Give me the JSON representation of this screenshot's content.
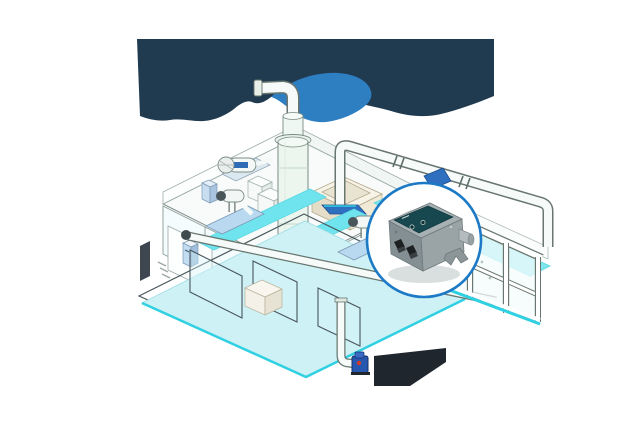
{
  "scene": {
    "name": "aquaculture-water-treatment-facility-illustration",
    "width": 640,
    "height": 425,
    "background": "#ffffff"
  },
  "palette": {
    "navy_blob": "#203a50",
    "blue_blob": "#2e7ec2",
    "floor_white": "#f8fbfa",
    "wall_white": "#fdfefe",
    "outline_gray": "#7c8c88",
    "water_surface": "#cdf1f5",
    "channel_cyan": "#6fe4ee",
    "cyan_edge": "#2fd0e2",
    "pipe_fill": "#f6faf8",
    "pipe_outline": "#68766f",
    "pump_base_blue": "#b8d9f0",
    "flange_blue": "#2f6fc0",
    "tank_body": "#ecf6ef",
    "basin_cream": "#efe9d6",
    "cabinet_glass": "#f4fbfc",
    "shadow_dark": "#0d141b",
    "callout_border": "#1b79c6",
    "callout_fill": "#ffffff",
    "device_body_top": "#a7b0b2",
    "device_body_front": "#848f93",
    "device_body_side": "#9aa4a7",
    "device_panel_teal": "#17474f",
    "device_gland_black": "#1d2022",
    "valve_blue": "#2857b0",
    "valve_red": "#d0392b",
    "wall_device_blue": "#c2dcf2",
    "glass_pane": "#d7f5fa"
  },
  "callout": {
    "shape": "circle",
    "device": "control-box-device",
    "indicator_count": 2,
    "cable_gland_count": 2
  }
}
